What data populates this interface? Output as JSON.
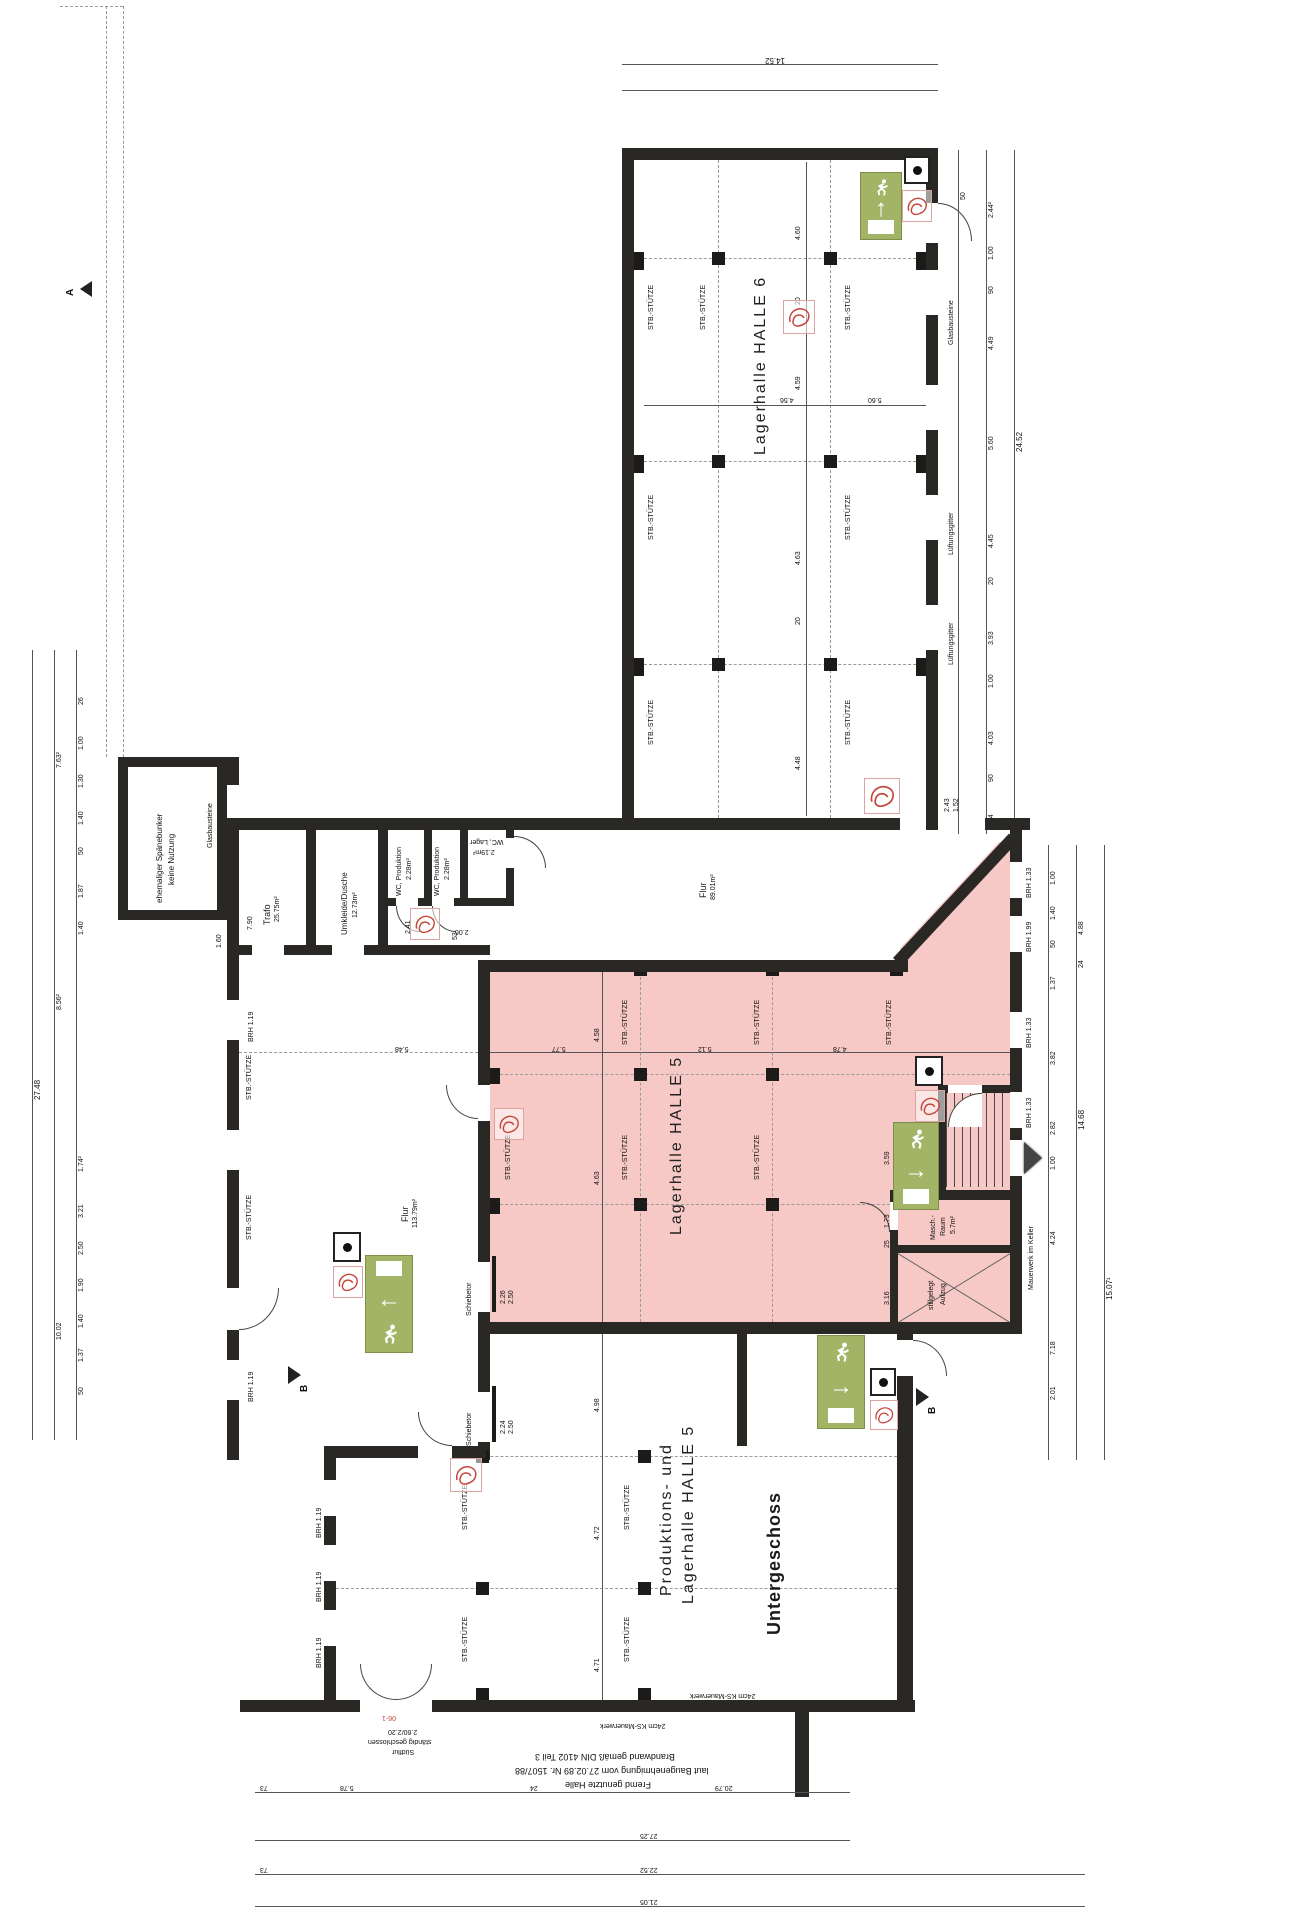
{
  "labels": {
    "stuetze": "STB.-STÜTZE",
    "halle6": "Lagerhalle  HALLE 6",
    "halle5": "Lagerhalle  HALLE 5",
    "prod_line1": "Produktions- und",
    "prod_line2": "Lagerhalle HALLE 5",
    "untergeschoss": "Untergeschoss",
    "flur": "Flur",
    "flur1_area": "89.01m²",
    "flur2_area": "113.79m²",
    "trafo": "Trafo",
    "trafo_area": "25.75m²",
    "umkleide": "Umkleide/Dusche",
    "umkleide_area": "12.73m²",
    "wc_prod": "WC, Produktion",
    "wc_prod_area": "2.28m²",
    "wc_lager": "WC, Lager",
    "wc_lager_area": "2.19m²",
    "masch_line1": "Masch.-",
    "masch_line2": "Raum",
    "masch_area": "5.7m²",
    "aufzug_line1": "stillgelegt",
    "aufzug_line2": "Aufzug",
    "bunker_line1": "ehemaliger Spänebunker",
    "bunker_line2": "keine Nutzung",
    "schiebetor": "Schiebetor",
    "glasbausteine": "Glasbausteine",
    "lueftungsgitter": "Lüftungsgitter",
    "mauerwerk_keller": "Mauerwerk im Keller",
    "ks_mauerwerk": "24cm KS-Mauerwerk",
    "suedflur_line1": "Südflur",
    "suedflur_line2": "ständig geschlossen",
    "suedflur_line3": "2.60/2.20",
    "note_line1": "Fremd genutzte Halle",
    "note_line2": "laut Baugenehmigung vom 27.02.89 Nr. 1507/88",
    "note_line3": "Brandwand gemäß DIN 4102 Teil 3",
    "brh119": "BRH 1.19",
    "brh133": "BRH 1.33",
    "brh199": "BRH 1.99"
  },
  "markers": {
    "section_b": "B",
    "section_a": "A",
    "door_tag": "06-1"
  },
  "icons": {
    "arrow_up": "↑",
    "arrow_left": "←",
    "arrow_right": "→"
  },
  "dims": {
    "top_total": "14.52",
    "h6_1": "4.60",
    "h6_2": "4.59",
    "h6_3": "4.63",
    "h6_4": "4.48",
    "h6_20": "20",
    "h6_h1": "4.56",
    "h6_h2": "5.60",
    "r1": "2.44²",
    "r2": "1.00",
    "r3": "90",
    "r4": "4.49",
    "r5": "5.60",
    "r6": "4.45",
    "r7": "3.93",
    "r8": "4.03",
    "r9": "4.44",
    "r10": "24.52",
    "r11": "50",
    "r12": "20",
    "rl1": "4.88",
    "rl2": "24",
    "rl3": "14.68",
    "rl4": "15.07¹",
    "rl5": "3.82",
    "rl6": "2.82",
    "rl7": "4.24",
    "rl8": "1.37",
    "rl9": "1.40",
    "rl10": "1.00",
    "rl11": "2.01",
    "rl12": "7.18",
    "rl13": "50",
    "l1": "7.63²",
    "l2": "27.48",
    "l3": "8.56²",
    "l4": "10.02",
    "l5": "26",
    "l6": "1.87",
    "l7": "1.74²",
    "l8": "3.21",
    "l9": "2.50",
    "l10": "1.90",
    "l11": "1.40",
    "l12": "50",
    "l13": "1.00",
    "l14": "1.37",
    "l15": "1.30",
    "p1": "4.58",
    "p2": "4.63",
    "p3": "5.77",
    "p4": "5.12",
    "p5": "4.78",
    "p6": "5.48",
    "g1": "2.43",
    "g2": "1.52",
    "s1": "3.59",
    "s2": "1.73",
    "s3": "3.16",
    "s4": "25",
    "w1": "53",
    "w2": "2.06",
    "w3": "2.41",
    "w4": "7.90",
    "w5": "1.60",
    "st1": "2.26",
    "st2": "2.50",
    "st3": "2.24",
    "st4": "2.50",
    "ph1": "4.98",
    "ph2": "4.72",
    "ph3": "4.71",
    "b1": "73",
    "b2": "5.78",
    "b3": "24",
    "b4": "20.79",
    "b5": "27.25",
    "b6": "22.52",
    "b7": "73",
    "b8": "21.05"
  }
}
